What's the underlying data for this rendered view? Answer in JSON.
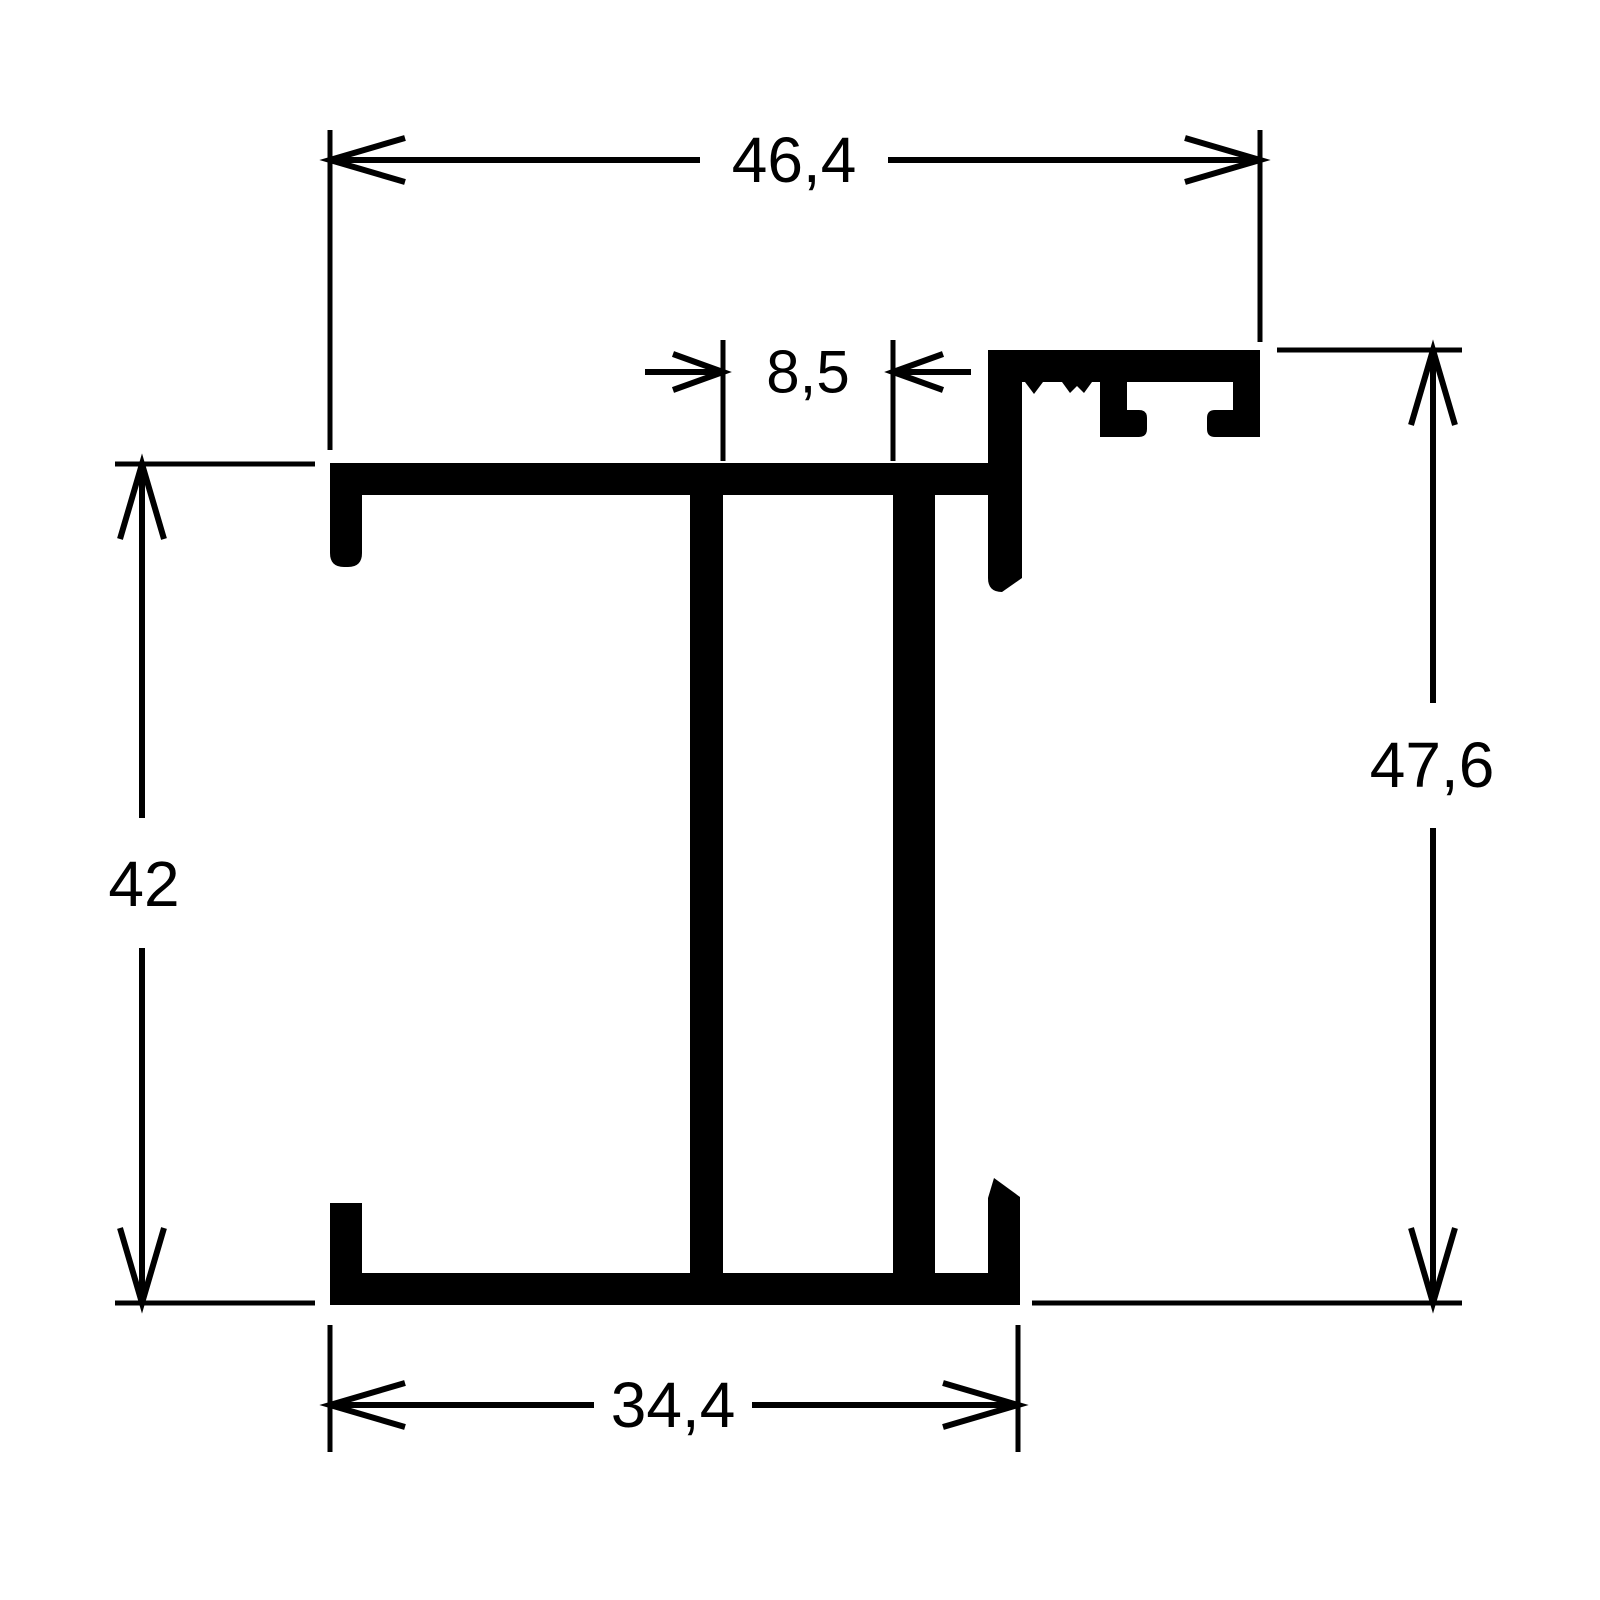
{
  "page": {
    "background": "#ffffff",
    "ink": "#000000",
    "drawing_type": "profile-cross-section"
  },
  "dims": {
    "top_width": "46,4",
    "web_gap": "8,5",
    "left_height": "42",
    "right_height": "47,6",
    "bottom_width": "34,4"
  }
}
